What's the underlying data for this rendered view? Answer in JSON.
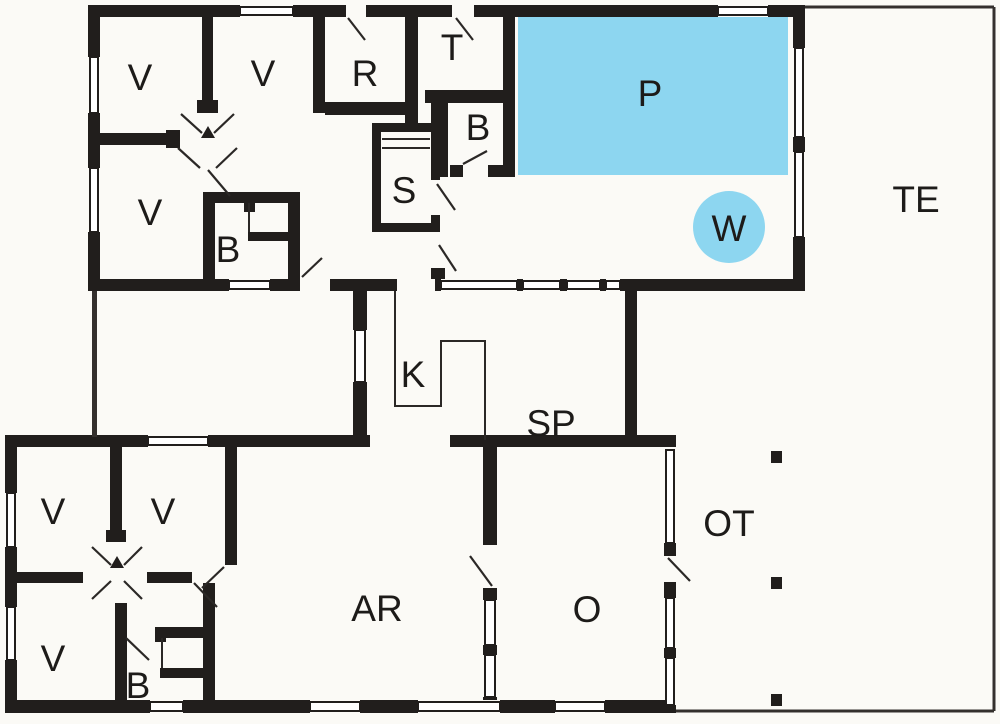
{
  "plan_title": "Holiday home floor plan",
  "colors": {
    "wall": "#211e1c",
    "pool_water": "#8dd6f0",
    "paper": "#fbfaf6",
    "line": "#2b2826"
  },
  "rooms": {
    "v_top_1": {
      "label": "V"
    },
    "v_top_2": {
      "label": "V"
    },
    "v_top_3": {
      "label": "V"
    },
    "r_room": {
      "label": "R"
    },
    "t_room": {
      "label": "T"
    },
    "b_top_right": {
      "label": "B"
    },
    "s_sauna": {
      "label": "S"
    },
    "b_top_left": {
      "label": "B"
    },
    "pool": {
      "label": "P"
    },
    "whirlpool": {
      "label": "W"
    },
    "terrace": {
      "label": "TE"
    },
    "kitchen": {
      "label": "K"
    },
    "dining": {
      "label": "SP"
    },
    "covered_terrace": {
      "label": "OT"
    },
    "o_room": {
      "label": "O"
    },
    "activity_room": {
      "label": "AR"
    },
    "v_bottom_1": {
      "label": "V"
    },
    "v_bottom_2": {
      "label": "V"
    },
    "v_bottom_3": {
      "label": "V"
    },
    "b_bottom": {
      "label": "B"
    }
  }
}
